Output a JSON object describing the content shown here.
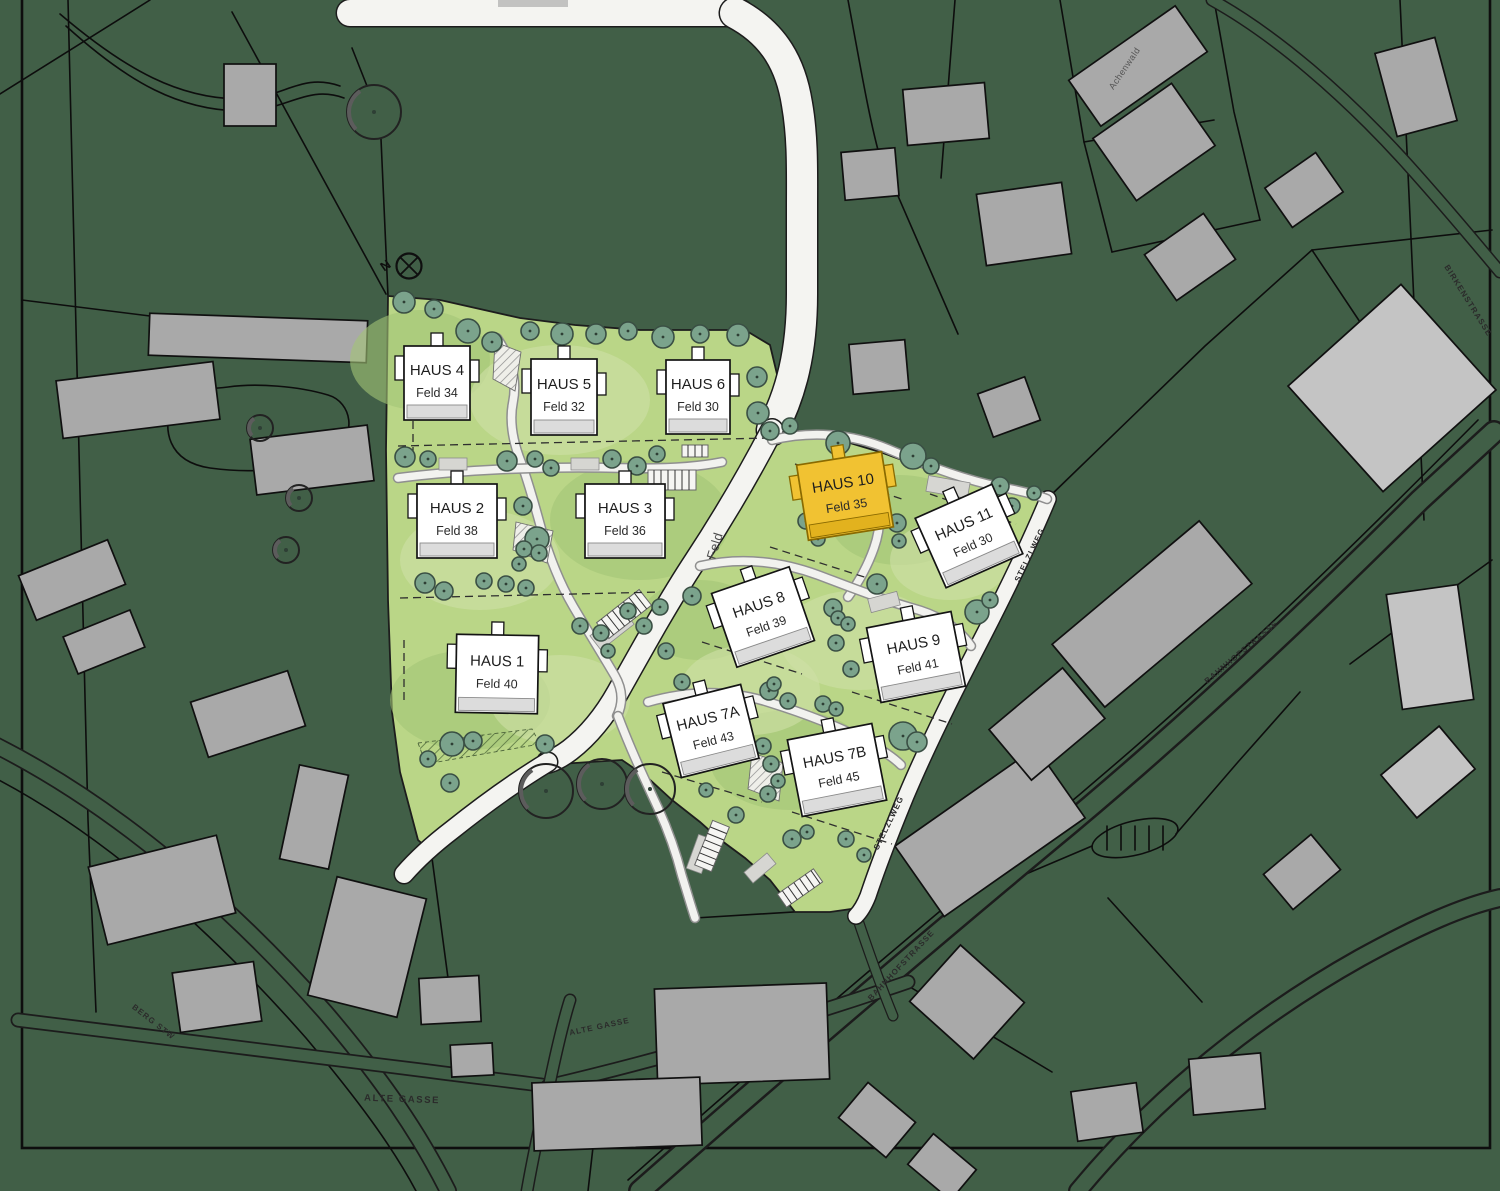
{
  "plan": {
    "north_label": "N",
    "houses": [
      {
        "id": "haus-4",
        "name": "HAUS 4",
        "feld": "Feld 34",
        "highlight": false
      },
      {
        "id": "haus-5",
        "name": "HAUS 5",
        "feld": "Feld 32",
        "highlight": false
      },
      {
        "id": "haus-6",
        "name": "HAUS 6",
        "feld": "Feld 30",
        "highlight": false
      },
      {
        "id": "haus-2",
        "name": "HAUS 2",
        "feld": "Feld 38",
        "highlight": false
      },
      {
        "id": "haus-3",
        "name": "HAUS 3",
        "feld": "Feld 36",
        "highlight": false
      },
      {
        "id": "haus-1",
        "name": "HAUS 1",
        "feld": "Feld 40",
        "highlight": false
      },
      {
        "id": "haus-10",
        "name": "HAUS 10",
        "feld": "Feld 35",
        "highlight": true
      },
      {
        "id": "haus-11",
        "name": "HAUS 11",
        "feld": "Feld 30",
        "highlight": false
      },
      {
        "id": "haus-8",
        "name": "HAUS 8",
        "feld": "Feld 39",
        "highlight": false
      },
      {
        "id": "haus-9",
        "name": "HAUS 9",
        "feld": "Feld 41",
        "highlight": false
      },
      {
        "id": "haus-7a",
        "name": "HAUS 7A",
        "feld": "Feld 43",
        "highlight": false
      },
      {
        "id": "haus-7b",
        "name": "HAUS 7B",
        "feld": "Feld 45",
        "highlight": false
      }
    ],
    "streets": {
      "feld": "Feld",
      "stelzlweg_upper": "STELZLWEG",
      "stelzlweg_lower": "STELZLWEG",
      "bahnhofstrasse_lower": "BAHNHOFSTRASSE",
      "bahnhofstrasse_upper": "BAHNHOFSTRASSE",
      "alte_gasse_west": "ALTE GASSE",
      "alte_gasse_east": "ALTE GASSE",
      "berg_stw": "BERG STW",
      "birkenstrasse": "BIRKENSTRASSE"
    },
    "buildings": {
      "achenwald": "Achenwald"
    },
    "colors": {
      "background_green": "#415f47",
      "site_green": "#bad687",
      "highlight_yellow": "#f1c232",
      "tree_green": "#7ba38c",
      "building_gray": "#a9a9a9",
      "road_white": "#f4f4f1"
    }
  }
}
